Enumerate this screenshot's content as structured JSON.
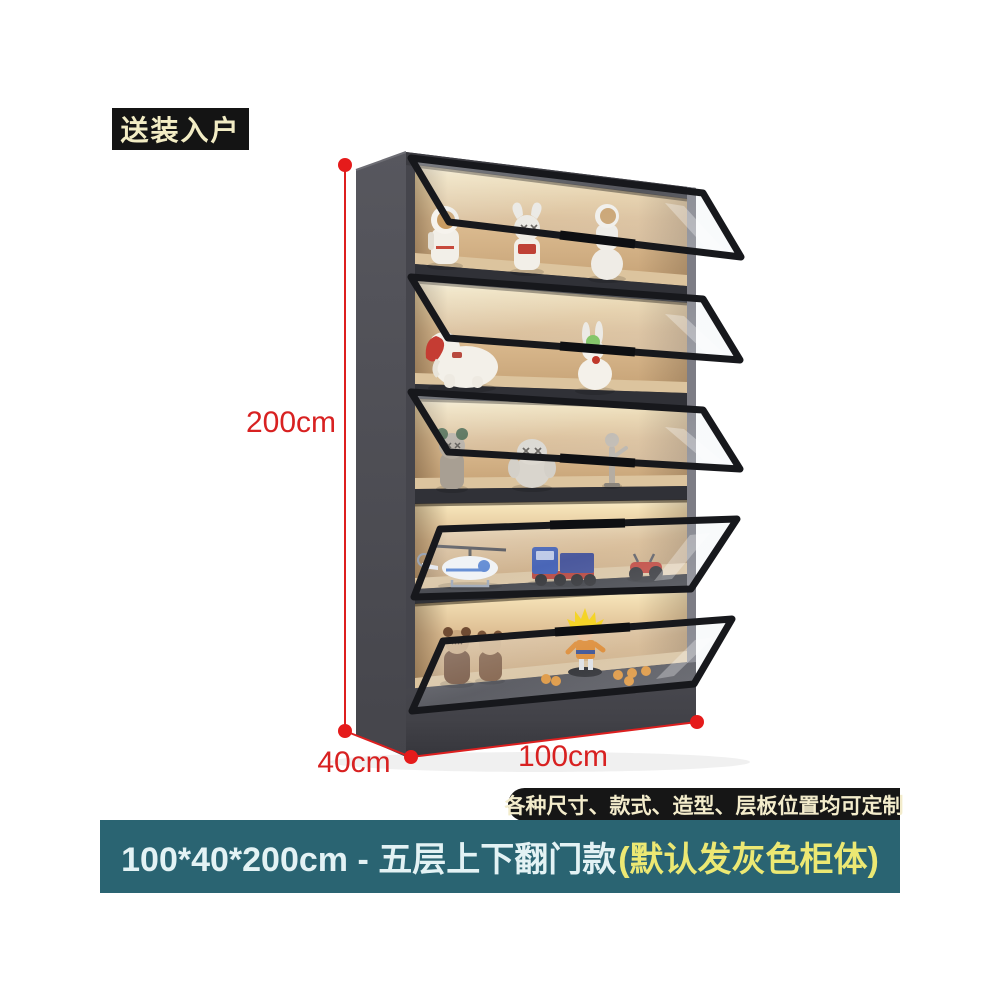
{
  "badge": {
    "label": "送装入户"
  },
  "dimensions": {
    "height_label": "200cm",
    "depth_label": "40cm",
    "width_label": "100cm",
    "annotation_color": "#dd1f1f"
  },
  "cabinet": {
    "body_color": "#4b4b52",
    "door_count": 5,
    "shelves": [
      {
        "name": "astronaut-figurines"
      },
      {
        "name": "elephant-and-rabbit-figurines"
      },
      {
        "name": "kaws-style-figurines"
      },
      {
        "name": "vehicle-models"
      },
      {
        "name": "bear-and-goku-figurines"
      }
    ]
  },
  "ribbon": {
    "label": "各种尺寸、款式、造型、层板位置均可定制"
  },
  "banner": {
    "text_main": "100*40*200cm - 五层上下翻门款 ",
    "text_highlight": "(默认发灰色柜体)",
    "background": "#2a6472",
    "highlight_color": "#ece873"
  }
}
